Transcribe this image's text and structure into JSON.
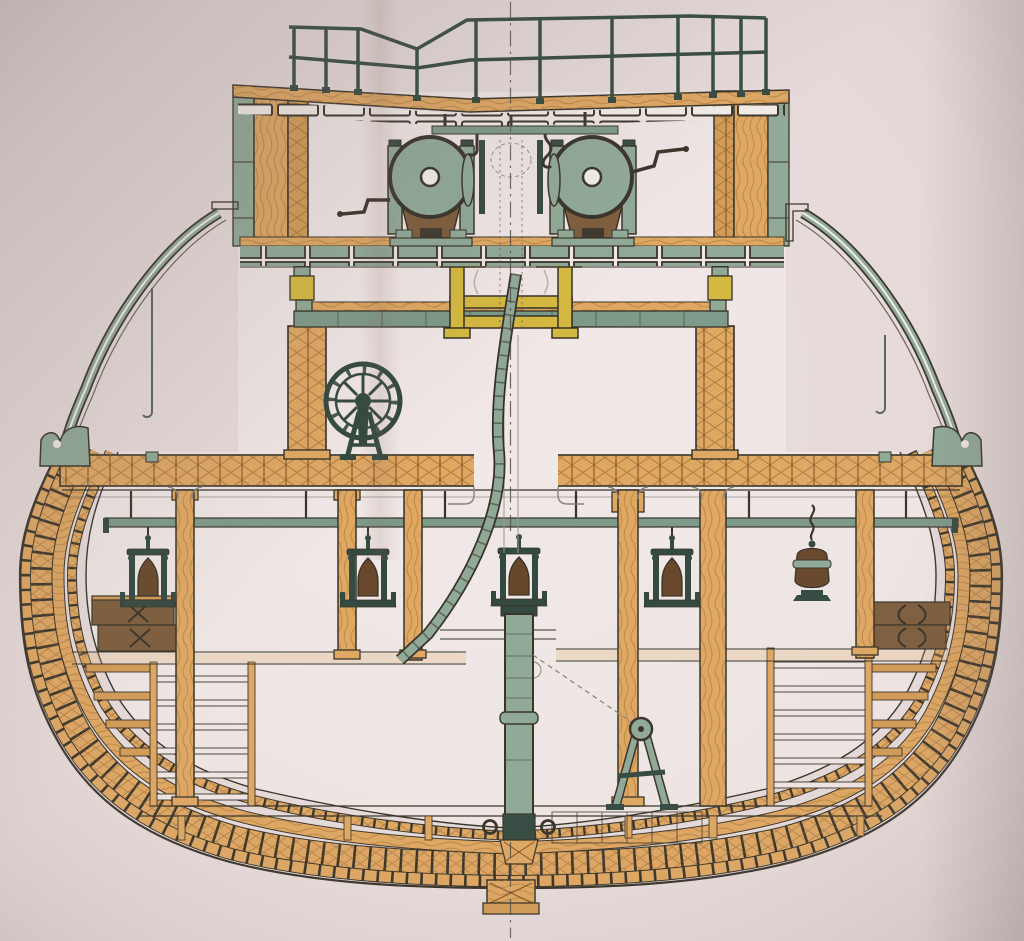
{
  "figure": {
    "description": "Hand-coloured 19th-century engineering plate: midship cross-section of a wooden steam vessel, showing top-deck railing, twin winch drums, yellow mast partners, a spoked flywheel, hanging lanterns on the lower deck, hold ladders, curved bulwarks and the heavy timber hull ring with keel.",
    "text_labels": []
  },
  "palette": {
    "paper": "#e7dcdb",
    "paper_light": "#f1e9e7",
    "ink": "#332f24",
    "wood": "#dfa65f",
    "wood_mid": "#d39a52",
    "wood_dark": "#7c5120",
    "grain": "#a4722e",
    "teal": "#8ea895",
    "teal_deck": "#7b9887",
    "teal_dark": "#2f463c",
    "yellow": "#d4b83e",
    "brown": "#7a5a38",
    "lamp": "#644426",
    "white": "#f4efe9",
    "metal": "#55625e",
    "knee": "#8a8173",
    "centerline": "#4a463c"
  }
}
